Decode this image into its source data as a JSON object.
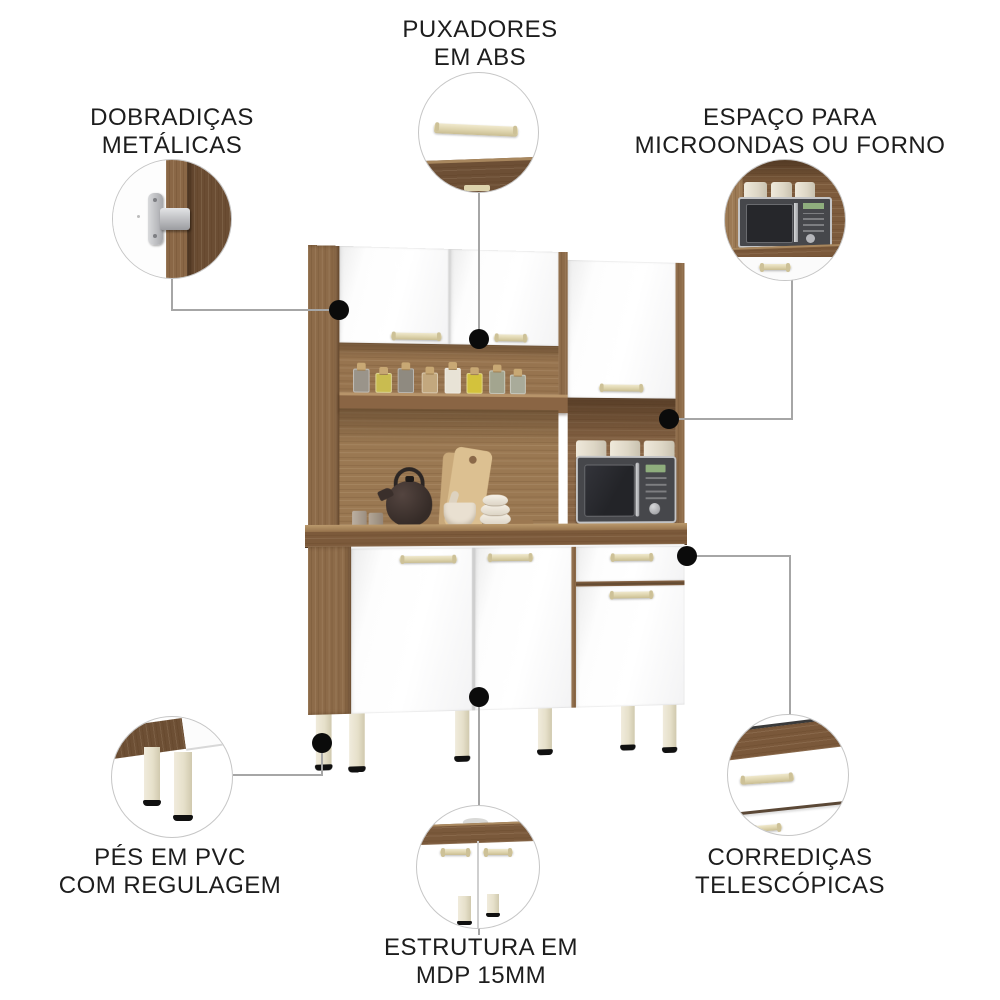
{
  "product_view": {
    "description_names": [
      "kitchen-cabinet"
    ],
    "colors": {
      "wood": "#8d6b49",
      "wood_dark": "#6e4f34",
      "door_white": "#fbfbfb",
      "handle_beige": "#ddd3ac",
      "leg_pvc": "#e8e3d0",
      "text": "#1d1d1d",
      "connector_line": "#a6a6a6",
      "callout_dot": "#0b0b0b",
      "circle_border": "#c6c6c6",
      "microwave_body": "#46474b",
      "microwave_display": "#8fae7d"
    }
  },
  "callouts": {
    "handles": {
      "line1": "PUXADORES",
      "line2": "EM ABS"
    },
    "hinges": {
      "line1": "DOBRADIÇAS",
      "line2": "METÁLICAS"
    },
    "microwave": {
      "line1": "ESPAÇO PARA",
      "line2": "MICROONDAS OU FORNO"
    },
    "feet": {
      "line1": "PÉS EM PVC",
      "line2": "COM REGULAGEM"
    },
    "structure": {
      "line1": "ESTRUTURA EM",
      "line2": "MDP 15MM"
    },
    "slides": {
      "line1": "CORREDIÇAS",
      "line2": "TELESCÓPICAS"
    }
  }
}
